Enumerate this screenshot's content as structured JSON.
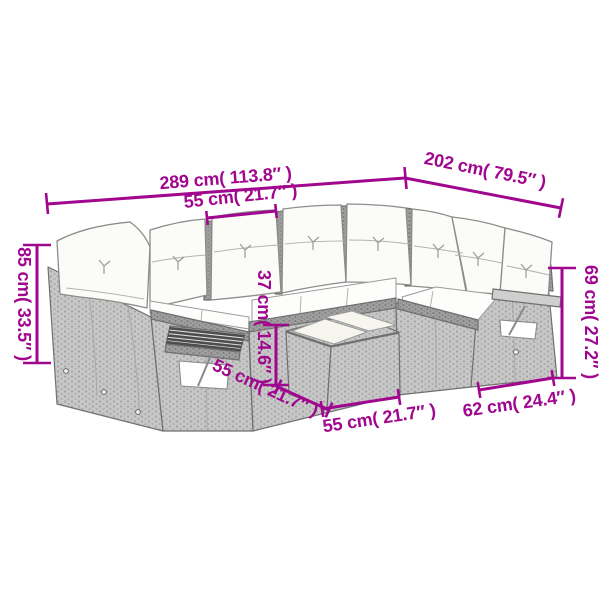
{
  "diagram": {
    "type": "product-dimension-diagram",
    "subject": "poly rattan garden sofa set with cushions and coffee table",
    "accent_color": "#a0078e",
    "background_color": "#ffffff",
    "dimensions": {
      "total_width": {
        "label": "289 cm( 113.8″ )",
        "value_cm": 289
      },
      "total_depth": {
        "label": "202 cm( 79.5″ )",
        "value_cm": 202
      },
      "seat_width": {
        "label": "55 cm( 21.7″ )",
        "value_cm": 55
      },
      "back_height": {
        "label": "85 cm( 33.5″ )",
        "value_cm": 85
      },
      "table_height": {
        "label": "37 cm( 14.6″ )",
        "value_cm": 37
      },
      "arm_height": {
        "label": "69 cm( 27.2″ )",
        "value_cm": 69
      },
      "table_depth": {
        "label": "55 cm( 21.7″ )",
        "value_cm": 55
      },
      "table_width": {
        "label": "55 cm( 21.7″ )",
        "value_cm": 55
      },
      "right_section_width": {
        "label": "62 cm( 24.4″ )",
        "value_cm": 62
      }
    }
  }
}
